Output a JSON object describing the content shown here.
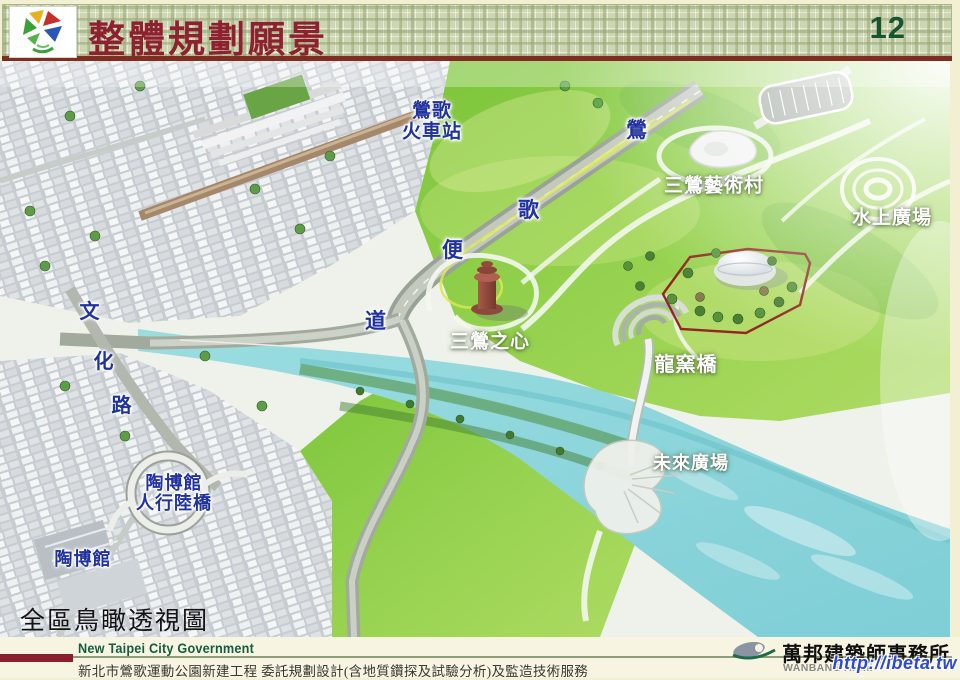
{
  "header": {
    "title": "整體規劃願景",
    "page_number": "12",
    "logo": "new-taipei-pinwheel-logo"
  },
  "map": {
    "caption": "全區鳥瞰透視圖",
    "labels": [
      {
        "id": "yingge-train-station",
        "lines": [
          "鶯歌",
          "火車站"
        ],
        "x": 432,
        "y": 61,
        "style": "blue",
        "size": 19
      },
      {
        "id": "yingge-bypass-char-1",
        "lines": [
          "鶯"
        ],
        "x": 637,
        "y": 70,
        "style": "blue",
        "size": 21
      },
      {
        "id": "yingge-bypass-char-2",
        "lines": [
          "歌"
        ],
        "x": 529,
        "y": 150,
        "style": "blue",
        "size": 21
      },
      {
        "id": "yingge-bypass-char-3",
        "lines": [
          "便"
        ],
        "x": 453,
        "y": 190,
        "style": "blue",
        "size": 21
      },
      {
        "id": "yingge-bypass-char-4",
        "lines": [
          "道"
        ],
        "x": 376,
        "y": 261,
        "style": "blue",
        "size": 21
      },
      {
        "id": "sanying-art-village",
        "lines": [
          "三鶯藝術村"
        ],
        "x": 714,
        "y": 125,
        "style": "white",
        "size": 19
      },
      {
        "id": "water-plaza",
        "lines": [
          "水上廣場"
        ],
        "x": 892,
        "y": 157,
        "style": "white",
        "size": 19
      },
      {
        "id": "sanying-heart",
        "lines": [
          "三鶯之心"
        ],
        "x": 490,
        "y": 281,
        "style": "white",
        "size": 19
      },
      {
        "id": "dragon-kiln-bridge",
        "lines": [
          "龍窯橋"
        ],
        "x": 686,
        "y": 304,
        "style": "white",
        "size": 20
      },
      {
        "id": "future-plaza",
        "lines": [
          "未來廣場"
        ],
        "x": 691,
        "y": 402,
        "style": "white",
        "size": 18
      },
      {
        "id": "wenhua-road-char-1",
        "lines": [
          "文"
        ],
        "x": 90,
        "y": 251,
        "style": "blue",
        "size": 20
      },
      {
        "id": "wenhua-road-char-2",
        "lines": [
          "化"
        ],
        "x": 104,
        "y": 301,
        "style": "blue",
        "size": 20
      },
      {
        "id": "wenhua-road-char-3",
        "lines": [
          "路"
        ],
        "x": 122,
        "y": 345,
        "style": "blue",
        "size": 20
      },
      {
        "id": "ceramics-museum-footbridge",
        "lines": [
          "陶博館",
          "人行陸橋"
        ],
        "x": 174,
        "y": 432,
        "style": "blue",
        "size": 18
      },
      {
        "id": "ceramics-museum",
        "lines": [
          "陶博館"
        ],
        "x": 83,
        "y": 498,
        "style": "blue",
        "size": 18
      }
    ]
  },
  "footer": {
    "gov_en": "New Taipei City Government",
    "project": "新北市鶯歌運動公園新建工程  委託規劃設計(含地質鑽探及試驗分析)及監造技術服務",
    "firm": "萬邦建築師事務所",
    "firm_en": "WANBANG Archi",
    "watermark": "http://ibeta.tw"
  },
  "colors": {
    "header_checker": "#ccd6b2",
    "title_red": "#8e2130",
    "page_number_green": "#17552e",
    "underline_maroon": "#7d2d22",
    "label_blue": "#20329e",
    "footer_green": "#155c40",
    "footer_redbar": "#8c1f2e",
    "watermark_blue": "#2d49d4",
    "river": "#8fd4d8",
    "park_green": "#8fcf48",
    "boundary_red": "#8e1f1f"
  }
}
